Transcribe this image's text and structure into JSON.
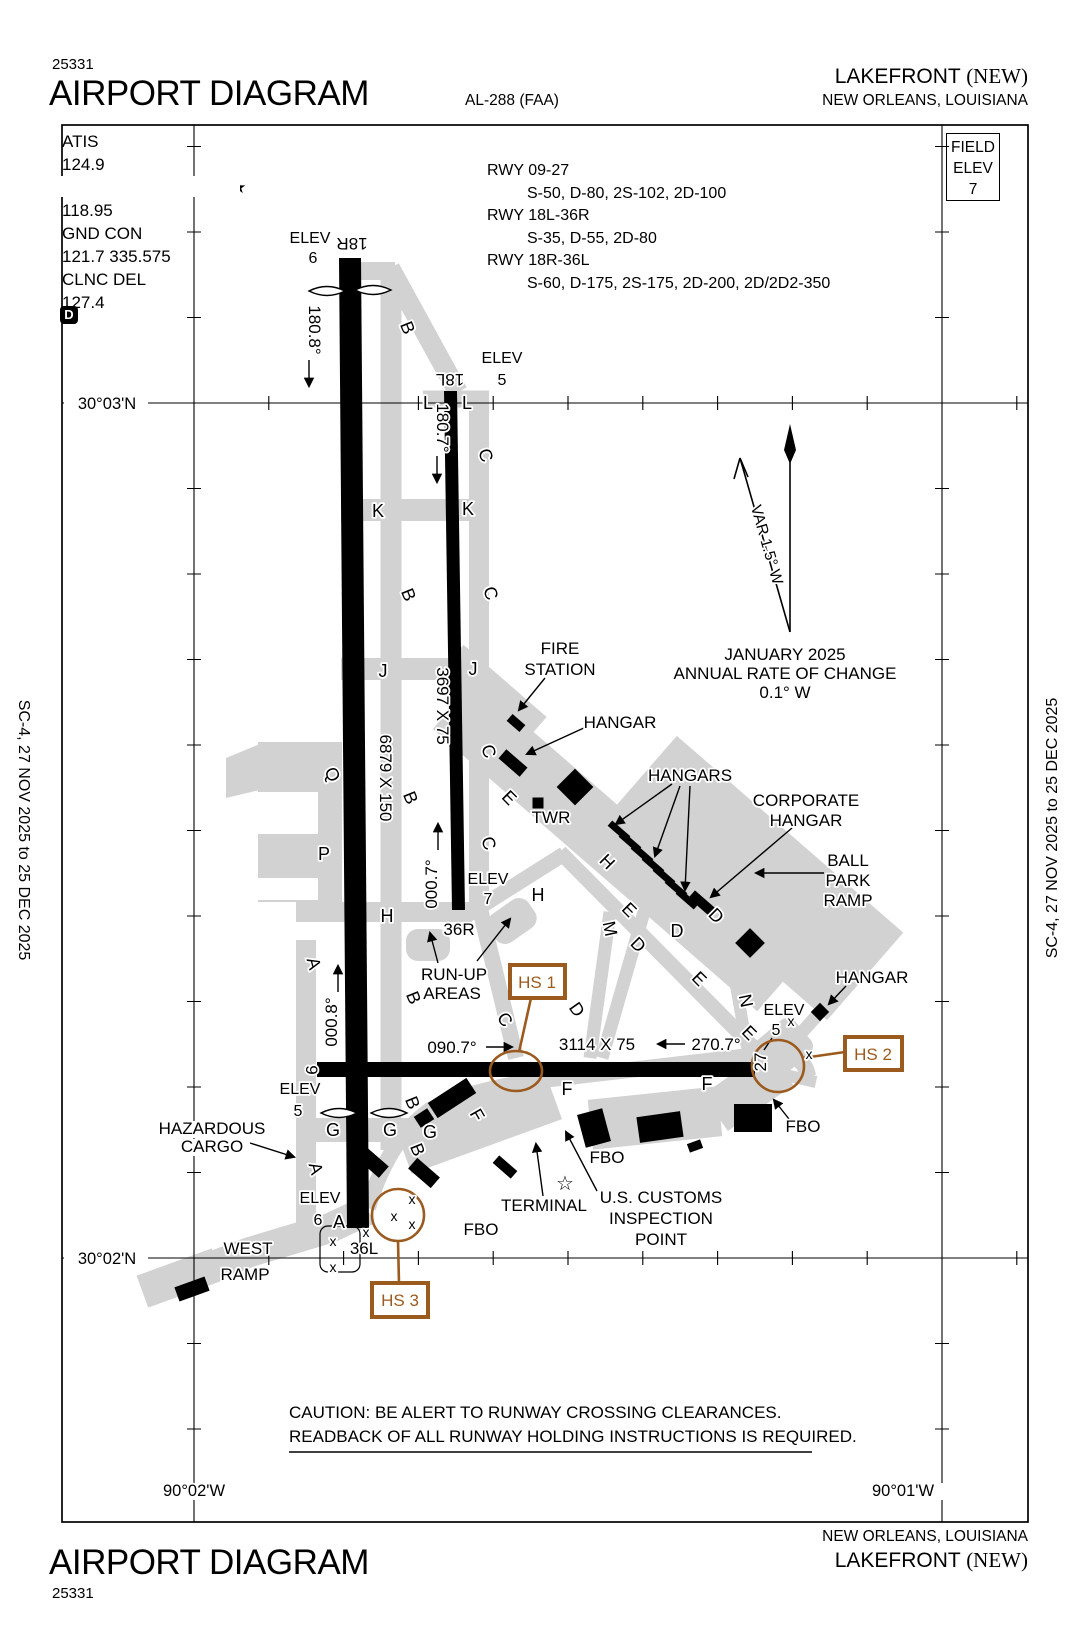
{
  "header": {
    "chart_num": "25331",
    "title": "AIRPORT DIAGRAM",
    "al": "AL-288 (FAA)",
    "airport": "LAKEFRONT",
    "apt_id": "(NEW)",
    "city": "NEW ORLEANS,  LOUISIANA"
  },
  "footer": {
    "chart_num": "25331",
    "title": "AIRPORT DIAGRAM",
    "airport": "LAKEFRONT",
    "apt_id": "(NEW)",
    "city": "NEW ORLEANS,  LOUISIANA"
  },
  "sidebar": {
    "left": "SC-4,  27 NOV 2025  to  25 DEC 2025",
    "right": "SC-4,  27 NOV 2025  to  25 DEC 2025"
  },
  "comms": {
    "lines": [
      "ATIS",
      "124.9",
      "LAKEFRONT TOWER★",
      "118.95",
      "GND CON",
      "121.7 335.575",
      "CLNC DEL",
      "127.4"
    ],
    "d_badge": "D"
  },
  "runway_data": {
    "rows": [
      {
        "rwy": "RWY 09-27",
        "codes": "S-50, D-80, 2S-102, 2D-100"
      },
      {
        "rwy": "RWY 18L-36R",
        "codes": "S-35, D-55, 2D-80"
      },
      {
        "rwy": "RWY 18R-36L",
        "codes": "S-60, D-175, 2S-175, 2D-200, 2D/2D2-350"
      }
    ]
  },
  "field_elev": {
    "l1": "FIELD",
    "l2": "ELEV",
    "value": "7"
  },
  "caution": {
    "l1": "CAUTION: BE ALERT TO RUNWAY CROSSING CLEARANCES.",
    "l2": "READBACK OF  ALL RUNWAY HOLDING INSTRUCTIONS IS REQUIRED."
  },
  "map": {
    "labels": [
      {
        "t": "180.8°",
        "x": 309,
        "y": 330,
        "r": 90
      },
      {
        "t": "180.7°",
        "x": 437,
        "y": 428,
        "r": 90
      },
      {
        "t": "3697 X 75",
        "x": 437,
        "y": 706,
        "r": 90
      },
      {
        "t": "6879 X 150",
        "x": 380,
        "y": 778,
        "r": 90
      },
      {
        "t": "000.7°",
        "x": 437,
        "y": 884,
        "r": -90
      },
      {
        "t": "000.8°",
        "x": 337,
        "y": 1022,
        "r": -90
      },
      {
        "t": "090.7°",
        "x": 452,
        "y": 1053
      },
      {
        "t": "3114 X 75",
        "x": 597,
        "y": 1050
      },
      {
        "t": "270.7°",
        "x": 716,
        "y": 1050
      },
      {
        "t": "18R",
        "x": 352,
        "y": 238,
        "r": 180
      },
      {
        "t": "18L",
        "x": 450,
        "y": 374,
        "r": 180
      },
      {
        "t": "36R",
        "x": 459,
        "y": 935
      },
      {
        "t": "36L",
        "x": 364,
        "y": 1254
      },
      {
        "t": "9",
        "x": 306,
        "y": 1070,
        "r": 90,
        "n": "rwy9"
      },
      {
        "t": "27",
        "x": 766,
        "y": 1062,
        "r": -90,
        "n": "rwy27"
      },
      {
        "t": "ELEV",
        "x": 310,
        "y": 243,
        "s": 16
      },
      {
        "t": "6",
        "x": 313,
        "y": 263,
        "s": 16
      },
      {
        "t": "ELEV",
        "x": 502,
        "y": 363,
        "s": 16
      },
      {
        "t": "5",
        "x": 502,
        "y": 385,
        "s": 16
      },
      {
        "t": "ELEV",
        "x": 488,
        "y": 884,
        "s": 16
      },
      {
        "t": "7",
        "x": 488,
        "y": 904,
        "s": 16
      },
      {
        "t": "ELEV",
        "x": 300,
        "y": 1094,
        "s": 16
      },
      {
        "t": "5",
        "x": 298,
        "y": 1116,
        "s": 16
      },
      {
        "t": "ELEV",
        "x": 784,
        "y": 1015,
        "s": 16
      },
      {
        "t": "5",
        "x": 776,
        "y": 1035,
        "s": 16
      },
      {
        "t": "ELEV",
        "x": 320,
        "y": 1203,
        "s": 16
      },
      {
        "t": "6",
        "x": 318,
        "y": 1225,
        "s": 16
      },
      {
        "t": "FIRE",
        "x": 560,
        "y": 654
      },
      {
        "t": "STATION",
        "x": 560,
        "y": 675
      },
      {
        "t": "HANGAR",
        "x": 620,
        "y": 728,
        "n": "hangar-nw"
      },
      {
        "t": "HANGARS",
        "x": 690,
        "y": 781
      },
      {
        "t": "CORPORATE",
        "x": 806,
        "y": 806
      },
      {
        "t": "HANGAR",
        "x": 806,
        "y": 826,
        "n": "hangar-corporate"
      },
      {
        "t": "BALL",
        "x": 848,
        "y": 866
      },
      {
        "t": "PARK",
        "x": 848,
        "y": 886
      },
      {
        "t": "RAMP",
        "x": 848,
        "y": 906,
        "n": "ramp-ballpark"
      },
      {
        "t": "TWR",
        "x": 551,
        "y": 823
      },
      {
        "t": "HANGAR",
        "x": 872,
        "y": 983,
        "n": "hangar-east"
      },
      {
        "t": "RUN-UP",
        "x": 454,
        "y": 980
      },
      {
        "t": "AREAS",
        "x": 452,
        "y": 999
      },
      {
        "t": "HAZARDOUS",
        "x": 212,
        "y": 1134
      },
      {
        "t": "CARGO",
        "x": 212,
        "y": 1152
      },
      {
        "t": "WEST",
        "x": 248,
        "y": 1254
      },
      {
        "t": "RAMP",
        "x": 245,
        "y": 1280,
        "n": "ramp-west"
      },
      {
        "t": "TERMINAL",
        "x": 544,
        "y": 1211
      },
      {
        "t": "FBO",
        "x": 607,
        "y": 1163,
        "n": "fbo-1"
      },
      {
        "t": "FBO",
        "x": 803,
        "y": 1132,
        "n": "fbo-2"
      },
      {
        "t": "FBO",
        "x": 481,
        "y": 1235,
        "n": "fbo-3"
      },
      {
        "t": "U.S. CUSTOMS",
        "x": 661,
        "y": 1203
      },
      {
        "t": "INSPECTION",
        "x": 661,
        "y": 1224
      },
      {
        "t": "POINT",
        "x": 661,
        "y": 1245
      },
      {
        "t": "B",
        "x": 402,
        "y": 330,
        "r": 68,
        "s": 18
      },
      {
        "t": "B",
        "x": 403,
        "y": 597,
        "r": 68,
        "s": 18
      },
      {
        "t": "B",
        "x": 405,
        "y": 800,
        "r": 68,
        "s": 18
      },
      {
        "t": "B",
        "x": 408,
        "y": 1000,
        "r": 68,
        "s": 18
      },
      {
        "t": "B",
        "x": 407,
        "y": 1105,
        "r": 68,
        "s": 18
      },
      {
        "t": "B",
        "x": 412,
        "y": 1152,
        "r": 68,
        "s": 18
      },
      {
        "t": "C",
        "x": 480,
        "y": 457,
        "r": 72,
        "s": 18
      },
      {
        "t": "C",
        "x": 485,
        "y": 595,
        "r": 72,
        "s": 18
      },
      {
        "t": "C",
        "x": 483,
        "y": 753,
        "r": 72,
        "s": 18
      },
      {
        "t": "C",
        "x": 483,
        "y": 845,
        "r": 72,
        "s": 18
      },
      {
        "t": "C",
        "x": 500,
        "y": 1023,
        "r": 55,
        "s": 18
      },
      {
        "t": "K",
        "x": 378,
        "y": 517,
        "s": 18
      },
      {
        "t": "K",
        "x": 468,
        "y": 515,
        "s": 18
      },
      {
        "t": "J",
        "x": 383,
        "y": 677,
        "s": 18
      },
      {
        "t": "J",
        "x": 473,
        "y": 675,
        "s": 18
      },
      {
        "t": "L",
        "x": 428,
        "y": 409,
        "s": 18
      },
      {
        "t": "L",
        "x": 467,
        "y": 409,
        "s": 18
      },
      {
        "t": "Q",
        "x": 327,
        "y": 777,
        "r": 65,
        "s": 18
      },
      {
        "t": "P",
        "x": 324,
        "y": 860,
        "s": 18
      },
      {
        "t": "H",
        "x": 387,
        "y": 922,
        "s": 18
      },
      {
        "t": "H",
        "x": 538,
        "y": 901,
        "s": 18
      },
      {
        "t": "H",
        "x": 603,
        "y": 866,
        "r": 45,
        "s": 18
      },
      {
        "t": "A",
        "x": 308,
        "y": 965,
        "r": 75,
        "s": 18
      },
      {
        "t": "A",
        "x": 310,
        "y": 1170,
        "r": 75,
        "s": 18
      },
      {
        "t": "A",
        "x": 339,
        "y": 1228,
        "s": 18
      },
      {
        "t": "G",
        "x": 333,
        "y": 1136,
        "s": 18
      },
      {
        "t": "G",
        "x": 390,
        "y": 1136,
        "s": 18
      },
      {
        "t": "G",
        "x": 430,
        "y": 1138,
        "s": 18
      },
      {
        "t": "E",
        "x": 505,
        "y": 802,
        "r": 45,
        "s": 18
      },
      {
        "t": "E",
        "x": 625,
        "y": 914,
        "r": 45,
        "s": 18
      },
      {
        "t": "E",
        "x": 695,
        "y": 983,
        "r": 45,
        "s": 18
      },
      {
        "t": "E",
        "x": 745,
        "y": 1037,
        "r": 45,
        "s": 18
      },
      {
        "t": "M",
        "x": 604,
        "y": 930,
        "r": 78,
        "s": 18
      },
      {
        "t": "D",
        "x": 634,
        "y": 949,
        "r": 45,
        "s": 18
      },
      {
        "t": "D",
        "x": 677,
        "y": 937,
        "s": 18
      },
      {
        "t": "D",
        "x": 572,
        "y": 1013,
        "r": 55,
        "s": 18
      },
      {
        "t": "D",
        "x": 712,
        "y": 920,
        "r": 45,
        "s": 18
      },
      {
        "t": "N",
        "x": 740,
        "y": 1002,
        "r": 78,
        "s": 18
      },
      {
        "t": "F",
        "x": 472,
        "y": 1118,
        "r": 60,
        "s": 18
      },
      {
        "t": "F",
        "x": 567,
        "y": 1095,
        "s": 18
      },
      {
        "t": "F",
        "x": 707,
        "y": 1090,
        "s": 18
      },
      {
        "t": "x",
        "x": 791,
        "y": 1026,
        "s": 14,
        "n": "x-mark"
      },
      {
        "t": "x",
        "x": 809,
        "y": 1059,
        "s": 14,
        "n": "x-mark"
      },
      {
        "t": "x",
        "x": 333,
        "y": 1246,
        "s": 14,
        "n": "x-mark"
      },
      {
        "t": "x",
        "x": 333,
        "y": 1272,
        "s": 14,
        "n": "x-mark"
      },
      {
        "t": "x",
        "x": 366,
        "y": 1237,
        "s": 14,
        "n": "x-mark"
      },
      {
        "t": "x",
        "x": 394,
        "y": 1221,
        "s": 14,
        "n": "x-mark"
      },
      {
        "t": "x",
        "x": 412,
        "y": 1204,
        "s": 14,
        "n": "x-mark"
      },
      {
        "t": "x",
        "x": 412,
        "y": 1229,
        "s": 14,
        "n": "x-mark"
      },
      {
        "t": "HS 1",
        "x": 537,
        "y": 988,
        "c": "br",
        "n": "hs1-label"
      },
      {
        "t": "HS 2",
        "x": 873,
        "y": 1060,
        "c": "br",
        "n": "hs2-label"
      },
      {
        "t": "HS 3",
        "x": 400,
        "y": 1306,
        "c": "br",
        "n": "hs3-label"
      },
      {
        "t": "VAR 1.5° W",
        "x": 762,
        "y": 546,
        "r": 74,
        "s": 15.5
      },
      {
        "t": "JANUARY 2025",
        "x": 785,
        "y": 660
      },
      {
        "t": "ANNUAL RATE OF CHANGE",
        "x": 785,
        "y": 679
      },
      {
        "t": "0.1° W",
        "x": 785,
        "y": 698
      },
      {
        "t": "30°03'N",
        "x": 107,
        "y": 409,
        "s": 16.5
      },
      {
        "t": "30°02'N",
        "x": 107,
        "y": 1264,
        "s": 16.5
      },
      {
        "t": "90°02'W",
        "x": 194,
        "y": 1496,
        "s": 16.5
      },
      {
        "t": "90°01'W",
        "x": 903,
        "y": 1496,
        "s": 16.5
      },
      {
        "t": "☆",
        "x": 565,
        "y": 1190,
        "s": 20,
        "n": "customs-star"
      }
    ]
  }
}
